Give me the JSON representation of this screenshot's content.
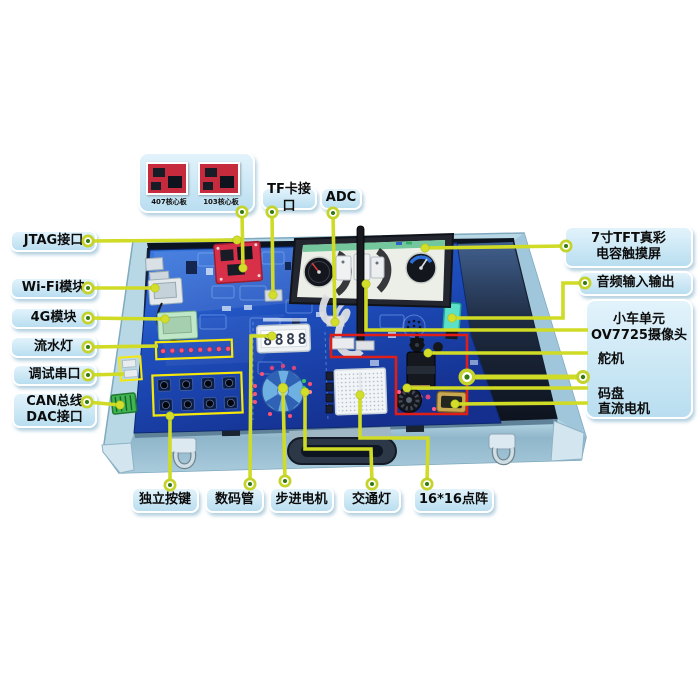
{
  "colors": {
    "leader_line": "#cfdb25",
    "dot_outer": "#c3d32a",
    "dot_center": "#35790f",
    "label_background": "#cfe9f6",
    "red_highlight_outline": "#e01e18",
    "yellow_component_outline": "#f6e70a",
    "board_blue": "#1d4fc0",
    "case_aluminum_blue": "#b8d8e6",
    "core_pcb_red": "#c62b3d"
  },
  "top_card": {
    "boards": [
      {
        "caption": "407核心板"
      },
      {
        "caption": "103核心板"
      }
    ]
  },
  "labels": {
    "tf_card": "TF卡接口",
    "adc": "ADC",
    "jtag": "JTAG接口",
    "wifi": "Wi-Fi模块",
    "module_4g": "4G模块",
    "led_strip": "流水灯",
    "debug_uart": "调试串口",
    "can_line1": "CAN总线",
    "can_line2": "DAC接口",
    "tft_line1": "7寸TFT真彩",
    "tft_line2": "电容触摸屏",
    "audio": "音频输入输出",
    "car_unit_line1": "小车单元",
    "car_unit_line2": "OV7725摄像头",
    "servo": "舵机",
    "encoder": "码盘",
    "dc_motor": "直流电机",
    "keys": "独立按键",
    "segment_display": "数码管",
    "stepper_motor": "步进电机",
    "traffic_light": "交通灯",
    "dot_matrix": "16*16点阵"
  },
  "board": {
    "seg_digits": "8888"
  }
}
